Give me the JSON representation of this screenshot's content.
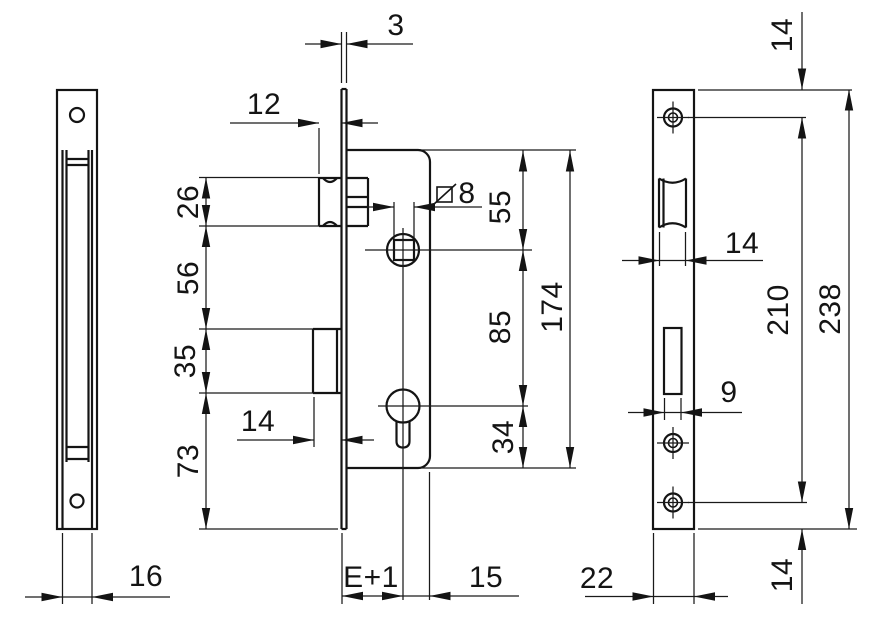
{
  "drawing": {
    "type": "mortise-lock dimensional drawing, three orthographic views",
    "line_color": "#141414",
    "background": "#ffffff"
  },
  "dimensions": {
    "case_depth": "16",
    "plate_thickness": "3",
    "latch_projection": "12",
    "latch_height": "26",
    "latch_to_deadbolt": "56",
    "deadbolt_height": "35",
    "deadbolt_to_plate_bottom": "73",
    "deadbolt_throw": "14",
    "spindle_square": "8",
    "top_to_spindle": "55",
    "spindle_to_cylinder": "85",
    "cylinder_to_bottom": "34",
    "case_height": "174",
    "backset_plus_one": "E+1",
    "axis_to_back": "15",
    "plate_top_to_screw": "14",
    "latch_width": "14",
    "screw_spacing": "210",
    "plate_height": "238",
    "deadbolt_width": "9",
    "screw_to_plate_bottom": "14",
    "plate_width": "22"
  }
}
